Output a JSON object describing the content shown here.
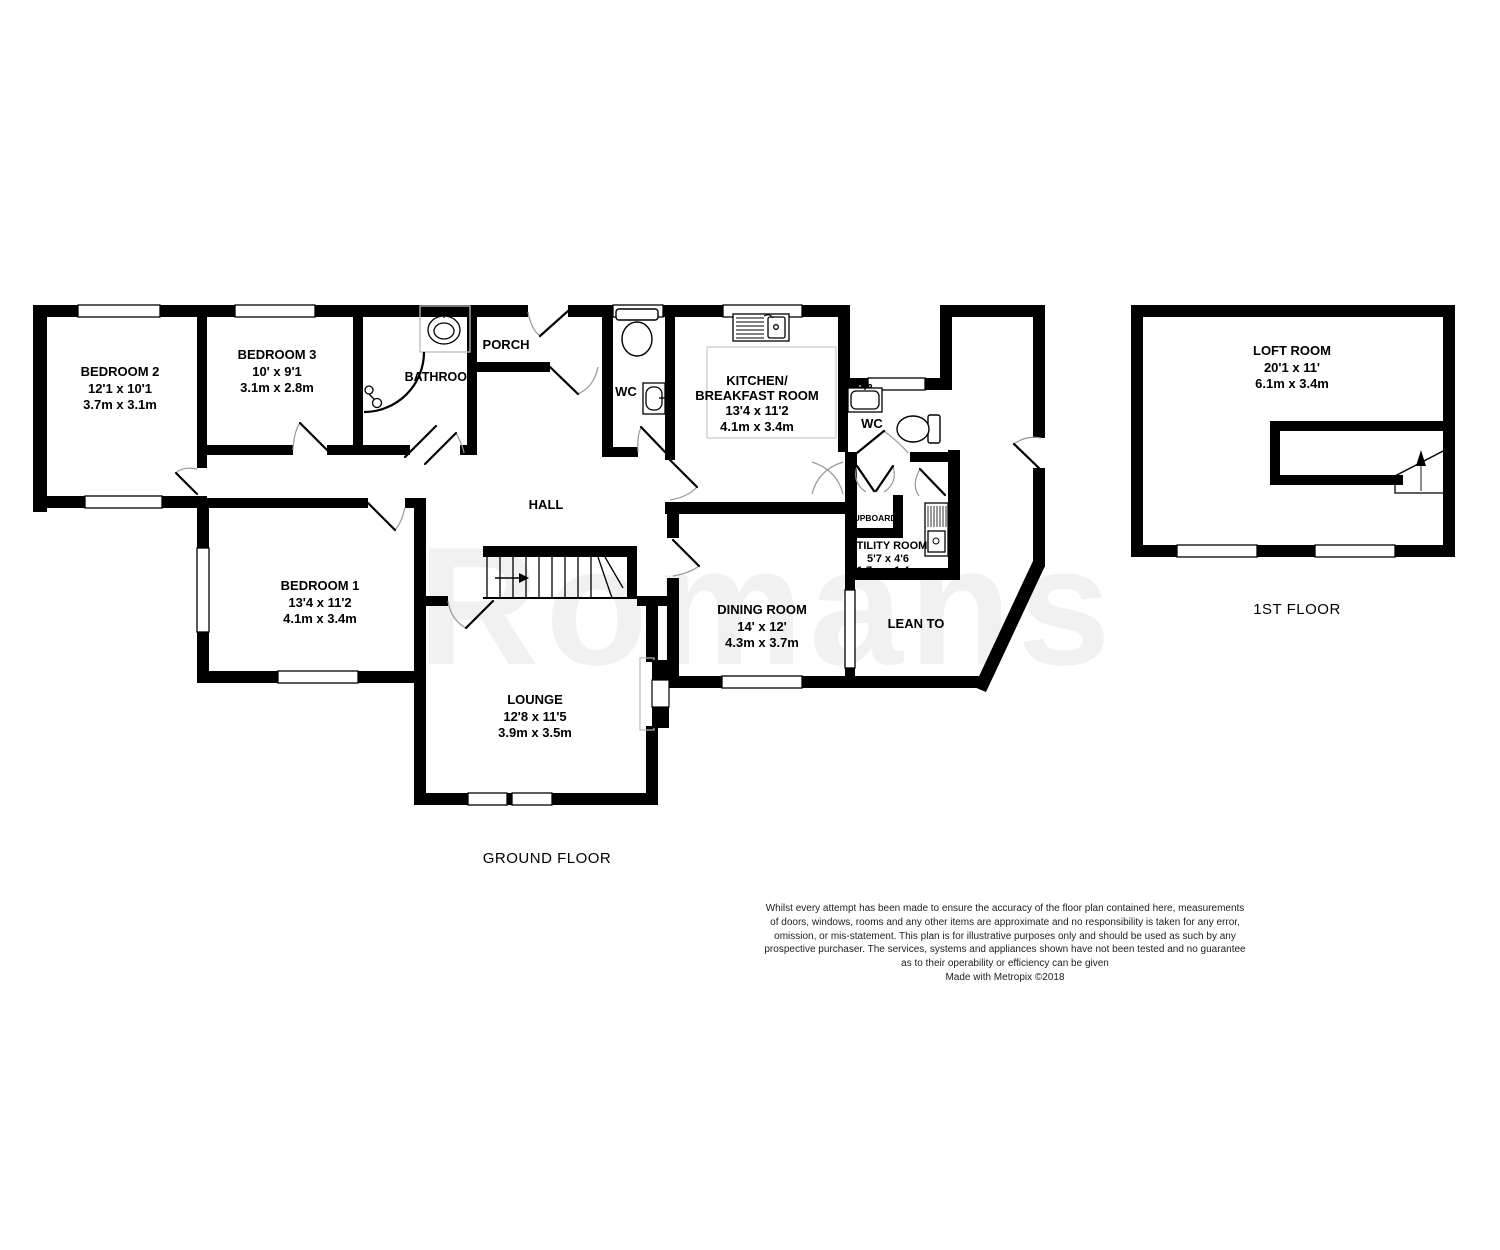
{
  "watermark": "Romans",
  "floor_labels": {
    "ground": "GROUND FLOOR",
    "first": "1ST FLOOR"
  },
  "rooms": {
    "bedroom2": {
      "name": "BEDROOM 2",
      "imperial": "12'1 x 10'1",
      "metric": "3.7m x 3.1m"
    },
    "bedroom3": {
      "name": "BEDROOM 3",
      "imperial": "10' x 9'1",
      "metric": "3.1m x 2.8m"
    },
    "bathroom": {
      "name": "BATHROOM"
    },
    "porch": {
      "name": "PORCH"
    },
    "wc_front": {
      "name": "WC"
    },
    "kitchen": {
      "name_line1": "KITCHEN/",
      "name_line2": "BREAKFAST ROOM",
      "imperial": "13'4 x 11'2",
      "metric": "4.1m x 3.4m"
    },
    "wc_rear": {
      "name": "WC"
    },
    "cupboard": {
      "name": "CUPBOARD"
    },
    "utility": {
      "name": "UTILITY ROOM",
      "imperial": "5'7 x 4'6",
      "metric": "1.7m x 1.4m"
    },
    "hall": {
      "name": "HALL"
    },
    "bedroom1": {
      "name": "BEDROOM 1",
      "imperial": "13'4 x 11'2",
      "metric": "4.1m x 3.4m"
    },
    "dining": {
      "name": "DINING ROOM",
      "imperial": "14' x 12'",
      "metric": "4.3m x 3.7m"
    },
    "lean_to": {
      "name": "LEAN TO"
    },
    "lounge": {
      "name": "LOUNGE",
      "imperial": "12'8 x 11'5",
      "metric": "3.9m x 3.5m"
    },
    "loft": {
      "name": "LOFT ROOM",
      "imperial": "20'1 x 11'",
      "metric": "6.1m x 3.4m"
    }
  },
  "fixtures": [
    "toilet-icon",
    "hand-basin-icon",
    "pedestal-sink-icon",
    "shower-icon",
    "kitchen-sink-icon",
    "washing-machine-icon",
    "fireplace-icon",
    "staircase-up-arrow-icon",
    "loft-staircase-up-arrow-icon",
    "window",
    "door-swing"
  ],
  "disclaimer": {
    "lines": [
      "Whilst every attempt has been made to ensure the accuracy of the floor plan contained here, measurements",
      "of doors, windows, rooms and any other items are approximate and no responsibility is taken for any error,",
      "omission, or mis-statement. This plan is for illustrative purposes only and should be used as such by any",
      "prospective purchaser. The services, systems and appliances shown have not been tested and no guarantee",
      "as to their operability or efficiency can be given"
    ],
    "credit": "Made with Metropix ©2018"
  },
  "colors": {
    "walls": "#000000",
    "background": "#ffffff",
    "fixture_outline": "#bbbbbb",
    "door_arc": "#999999"
  }
}
